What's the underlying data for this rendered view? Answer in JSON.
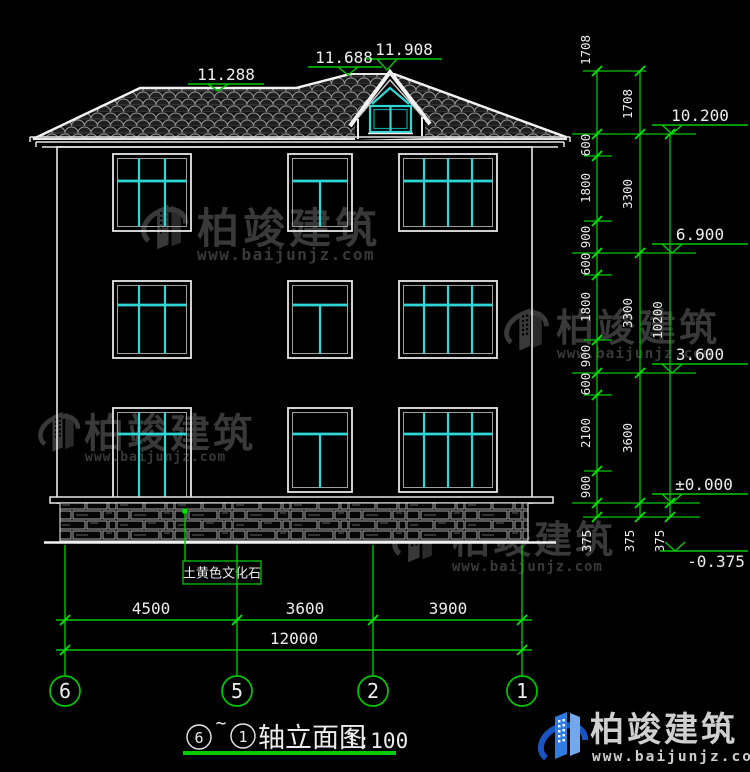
{
  "drawing_title": {
    "axis_from": "6",
    "separator": "~",
    "axis_to": "1",
    "name": "轴立面图",
    "scale": "1:100"
  },
  "top_markers": [
    "11.288",
    "11.688",
    "11.908"
  ],
  "right_markers": [
    "10.200",
    "6.900",
    "3.600",
    "±0.000",
    "-0.375"
  ],
  "dims": {
    "chain_detail": {
      "segments": [
        "1708",
        "600",
        "1800",
        "900",
        "600",
        "1800",
        "900",
        "600",
        "2100",
        "900"
      ],
      "below_ground": "375"
    },
    "chain_floor": {
      "segments": [
        "1708",
        "3300",
        "3300",
        "3600"
      ],
      "below_ground": "375"
    },
    "chain_total": {
      "value": "10200",
      "below_ground": "375"
    },
    "bottom": {
      "segments": [
        "4500",
        "3600",
        "3900"
      ],
      "total": "12000"
    }
  },
  "axes": [
    "6",
    "5",
    "2",
    "1"
  ],
  "material_callout": "土黄色文化石",
  "watermark": {
    "brand": "柏竣建筑",
    "url": "www.baijunjz.com"
  },
  "brand_footer": {
    "brand": "柏竣建筑",
    "url": "www.baijunjz.com"
  },
  "colors": {
    "background": "#000000",
    "cad_green": "#00c800",
    "cad_cyan": "#2fd6d6",
    "line_white": "#e8e8e8",
    "brand_blue": "#2f7de0",
    "watermark_gray": "#3e3e3e"
  }
}
